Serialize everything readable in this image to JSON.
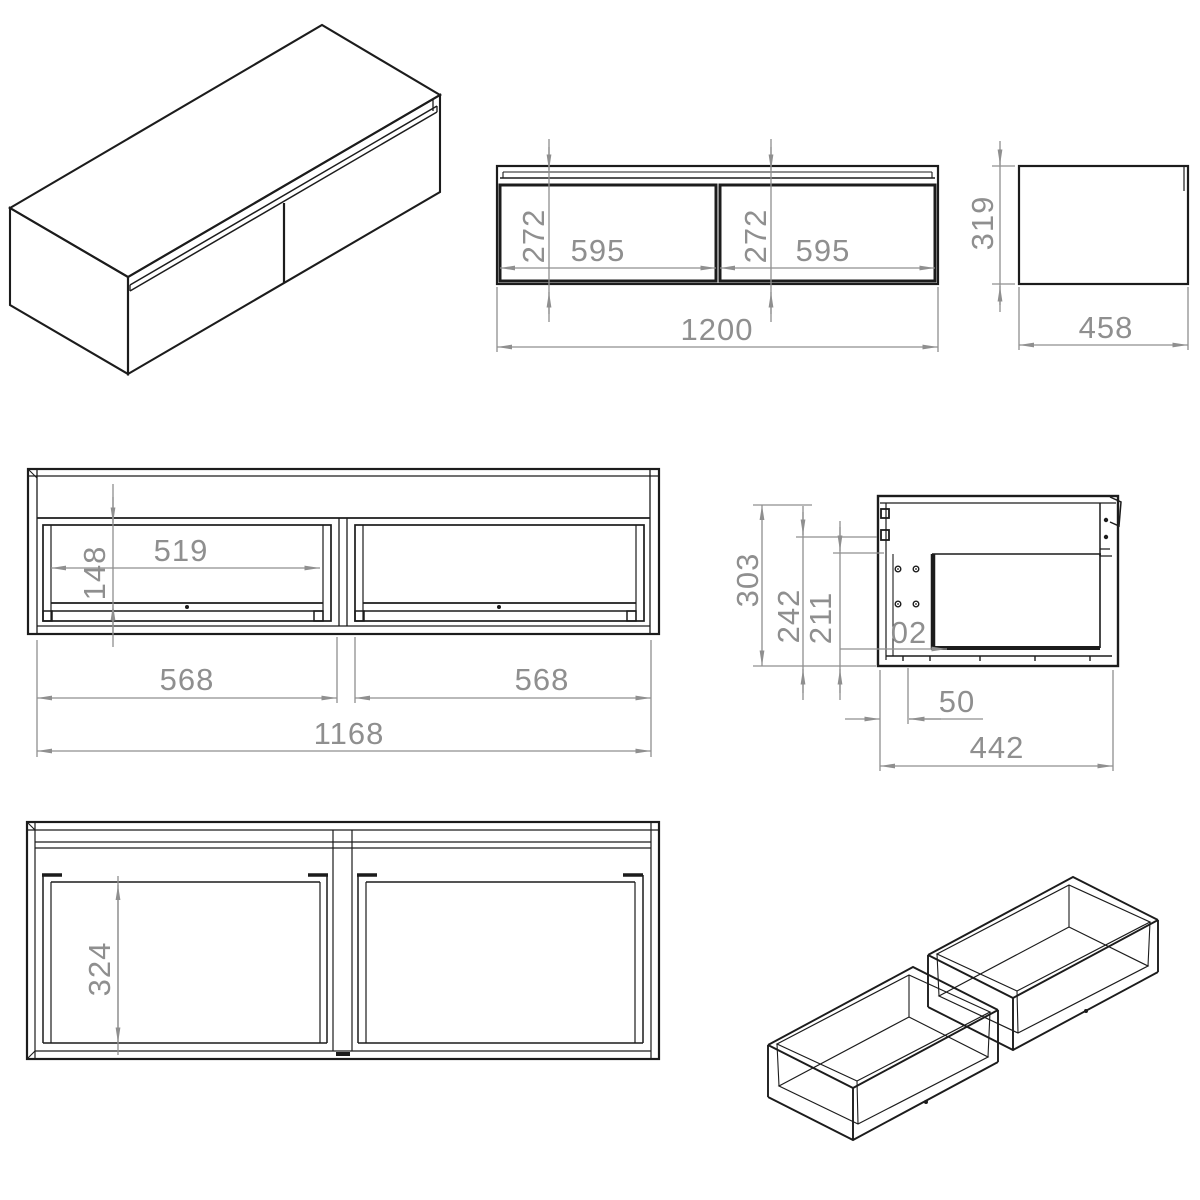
{
  "drawing": {
    "type": "furniture technical drawing, wall-hung two-drawer cabinet",
    "colors": {
      "line": "#1c1c1c",
      "dimension": "#8f8f8f",
      "background": "#ffffff"
    },
    "views": {
      "front_view": {
        "dims": {
          "drawer_height_left": "272",
          "drawer_width_left": "595",
          "drawer_height_right": "272",
          "drawer_width_right": "595",
          "overall_width": "1200"
        }
      },
      "side_view": {
        "dims": {
          "overall_height": "319",
          "overall_depth": "458"
        }
      },
      "carcass_front_view": {
        "dims": {
          "opening_width": "519",
          "opening_height": "148",
          "bay_width_left": "568",
          "bay_width_right": "568",
          "inner_width": "1168"
        }
      },
      "side_section_view": {
        "dims": {
          "height_303": "303",
          "height_242": "242",
          "height_211": "211",
          "partial_label": "02",
          "offset_50": "50",
          "depth_442": "442"
        }
      },
      "plan_view": {
        "dims": {
          "drawer_inner_depth": "324"
        }
      }
    }
  }
}
